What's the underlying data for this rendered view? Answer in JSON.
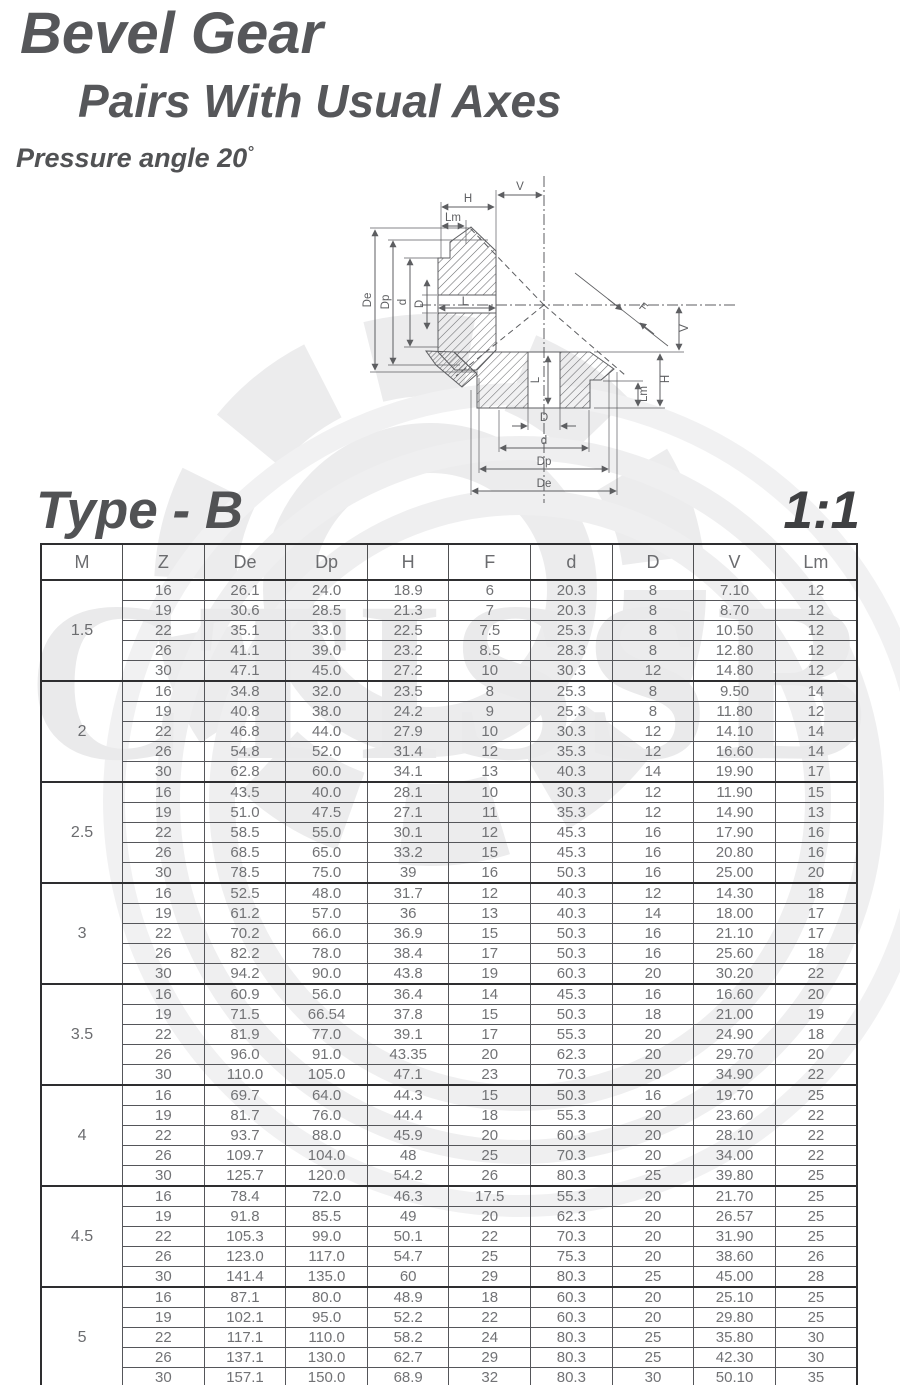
{
  "titles": {
    "line1": "Bevel Gear",
    "line2": "Pairs With Usual Axes",
    "pressure": "Pressure angle 20",
    "degree": "°",
    "type": "Type - B",
    "ratio": "1:1"
  },
  "watermark": {
    "text": "CTISSB"
  },
  "diagram": {
    "labels": {
      "v_top": "V",
      "h_top": "H",
      "lm_top": "Lm",
      "de_left": "De",
      "dp_left": "Dp",
      "d_left": "d",
      "bore_left": "D",
      "l_top_bore": "L",
      "f": "F",
      "v_right": "V",
      "h_right": "H",
      "lm_right": "Lm",
      "l_bottom_bore": "L",
      "bore_bottom": "D",
      "d_bottom": "d",
      "dp_bottom": "Dp",
      "de_bottom": "De"
    }
  },
  "table": {
    "columns": [
      "M",
      "Z",
      "De",
      "Dp",
      "H",
      "F",
      "d",
      "D",
      "V",
      "Lm"
    ],
    "groups": [
      {
        "m": "1.5",
        "rows": [
          [
            "16",
            "26.1",
            "24.0",
            "18.9",
            "6",
            "20.3",
            "8",
            "7.10",
            "12"
          ],
          [
            "19",
            "30.6",
            "28.5",
            "21.3",
            "7",
            "20.3",
            "8",
            "8.70",
            "12"
          ],
          [
            "22",
            "35.1",
            "33.0",
            "22.5",
            "7.5",
            "25.3",
            "8",
            "10.50",
            "12"
          ],
          [
            "26",
            "41.1",
            "39.0",
            "23.2",
            "8.5",
            "28.3",
            "8",
            "12.80",
            "12"
          ],
          [
            "30",
            "47.1",
            "45.0",
            "27.2",
            "10",
            "30.3",
            "12",
            "14.80",
            "12"
          ]
        ]
      },
      {
        "m": "2",
        "rows": [
          [
            "16",
            "34.8",
            "32.0",
            "23.5",
            "8",
            "25.3",
            "8",
            "9.50",
            "14"
          ],
          [
            "19",
            "40.8",
            "38.0",
            "24.2",
            "9",
            "25.3",
            "8",
            "11.80",
            "12"
          ],
          [
            "22",
            "46.8",
            "44.0",
            "27.9",
            "10",
            "30.3",
            "12",
            "14.10",
            "14"
          ],
          [
            "26",
            "54.8",
            "52.0",
            "31.4",
            "12",
            "35.3",
            "12",
            "16.60",
            "14"
          ],
          [
            "30",
            "62.8",
            "60.0",
            "34.1",
            "13",
            "40.3",
            "14",
            "19.90",
            "17"
          ]
        ]
      },
      {
        "m": "2.5",
        "rows": [
          [
            "16",
            "43.5",
            "40.0",
            "28.1",
            "10",
            "30.3",
            "12",
            "11.90",
            "15"
          ],
          [
            "19",
            "51.0",
            "47.5",
            "27.1",
            "11",
            "35.3",
            "12",
            "14.90",
            "13"
          ],
          [
            "22",
            "58.5",
            "55.0",
            "30.1",
            "12",
            "45.3",
            "16",
            "17.90",
            "16"
          ],
          [
            "26",
            "68.5",
            "65.0",
            "33.2",
            "15",
            "45.3",
            "16",
            "20.80",
            "16"
          ],
          [
            "30",
            "78.5",
            "75.0",
            "39",
            "16",
            "50.3",
            "16",
            "25.00",
            "20"
          ]
        ]
      },
      {
        "m": "3",
        "rows": [
          [
            "16",
            "52.5",
            "48.0",
            "31.7",
            "12",
            "40.3",
            "12",
            "14.30",
            "18"
          ],
          [
            "19",
            "61.2",
            "57.0",
            "36",
            "13",
            "40.3",
            "14",
            "18.00",
            "17"
          ],
          [
            "22",
            "70.2",
            "66.0",
            "36.9",
            "15",
            "50.3",
            "16",
            "21.10",
            "17"
          ],
          [
            "26",
            "82.2",
            "78.0",
            "38.4",
            "17",
            "50.3",
            "16",
            "25.60",
            "18"
          ],
          [
            "30",
            "94.2",
            "90.0",
            "43.8",
            "19",
            "60.3",
            "20",
            "30.20",
            "22"
          ]
        ]
      },
      {
        "m": "3.5",
        "rows": [
          [
            "16",
            "60.9",
            "56.0",
            "36.4",
            "14",
            "45.3",
            "16",
            "16.60",
            "20"
          ],
          [
            "19",
            "71.5",
            "66.54",
            "37.8",
            "15",
            "50.3",
            "18",
            "21.00",
            "19"
          ],
          [
            "22",
            "81.9",
            "77.0",
            "39.1",
            "17",
            "55.3",
            "20",
            "24.90",
            "18"
          ],
          [
            "26",
            "96.0",
            "91.0",
            "43.35",
            "20",
            "62.3",
            "20",
            "29.70",
            "20"
          ],
          [
            "30",
            "110.0",
            "105.0",
            "47.1",
            "23",
            "70.3",
            "20",
            "34.90",
            "22"
          ]
        ]
      },
      {
        "m": "4",
        "rows": [
          [
            "16",
            "69.7",
            "64.0",
            "44.3",
            "15",
            "50.3",
            "16",
            "19.70",
            "25"
          ],
          [
            "19",
            "81.7",
            "76.0",
            "44.4",
            "18",
            "55.3",
            "20",
            "23.60",
            "22"
          ],
          [
            "22",
            "93.7",
            "88.0",
            "45.9",
            "20",
            "60.3",
            "20",
            "28.10",
            "22"
          ],
          [
            "26",
            "109.7",
            "104.0",
            "48",
            "25",
            "70.3",
            "20",
            "34.00",
            "22"
          ],
          [
            "30",
            "125.7",
            "120.0",
            "54.2",
            "26",
            "80.3",
            "25",
            "39.80",
            "25"
          ]
        ]
      },
      {
        "m": "4.5",
        "rows": [
          [
            "16",
            "78.4",
            "72.0",
            "46.3",
            "17.5",
            "55.3",
            "20",
            "21.70",
            "25"
          ],
          [
            "19",
            "91.8",
            "85.5",
            "49",
            "20",
            "62.3",
            "20",
            "26.57",
            "25"
          ],
          [
            "22",
            "105.3",
            "99.0",
            "50.1",
            "22",
            "70.3",
            "20",
            "31.90",
            "25"
          ],
          [
            "26",
            "123.0",
            "117.0",
            "54.7",
            "25",
            "75.3",
            "20",
            "38.60",
            "26"
          ],
          [
            "30",
            "141.4",
            "135.0",
            "60",
            "29",
            "80.3",
            "25",
            "45.00",
            "28"
          ]
        ]
      },
      {
        "m": "5",
        "rows": [
          [
            "16",
            "87.1",
            "80.0",
            "48.9",
            "18",
            "60.3",
            "20",
            "25.10",
            "25"
          ],
          [
            "19",
            "102.1",
            "95.0",
            "52.2",
            "22",
            "60.3",
            "20",
            "29.80",
            "25"
          ],
          [
            "22",
            "117.1",
            "110.0",
            "58.2",
            "24",
            "80.3",
            "25",
            "35.80",
            "30"
          ],
          [
            "26",
            "137.1",
            "130.0",
            "62.7",
            "29",
            "80.3",
            "25",
            "42.30",
            "30"
          ],
          [
            "30",
            "157.1",
            "150.0",
            "68.9",
            "32",
            "80.3",
            "30",
            "50.10",
            "35"
          ]
        ]
      }
    ]
  }
}
